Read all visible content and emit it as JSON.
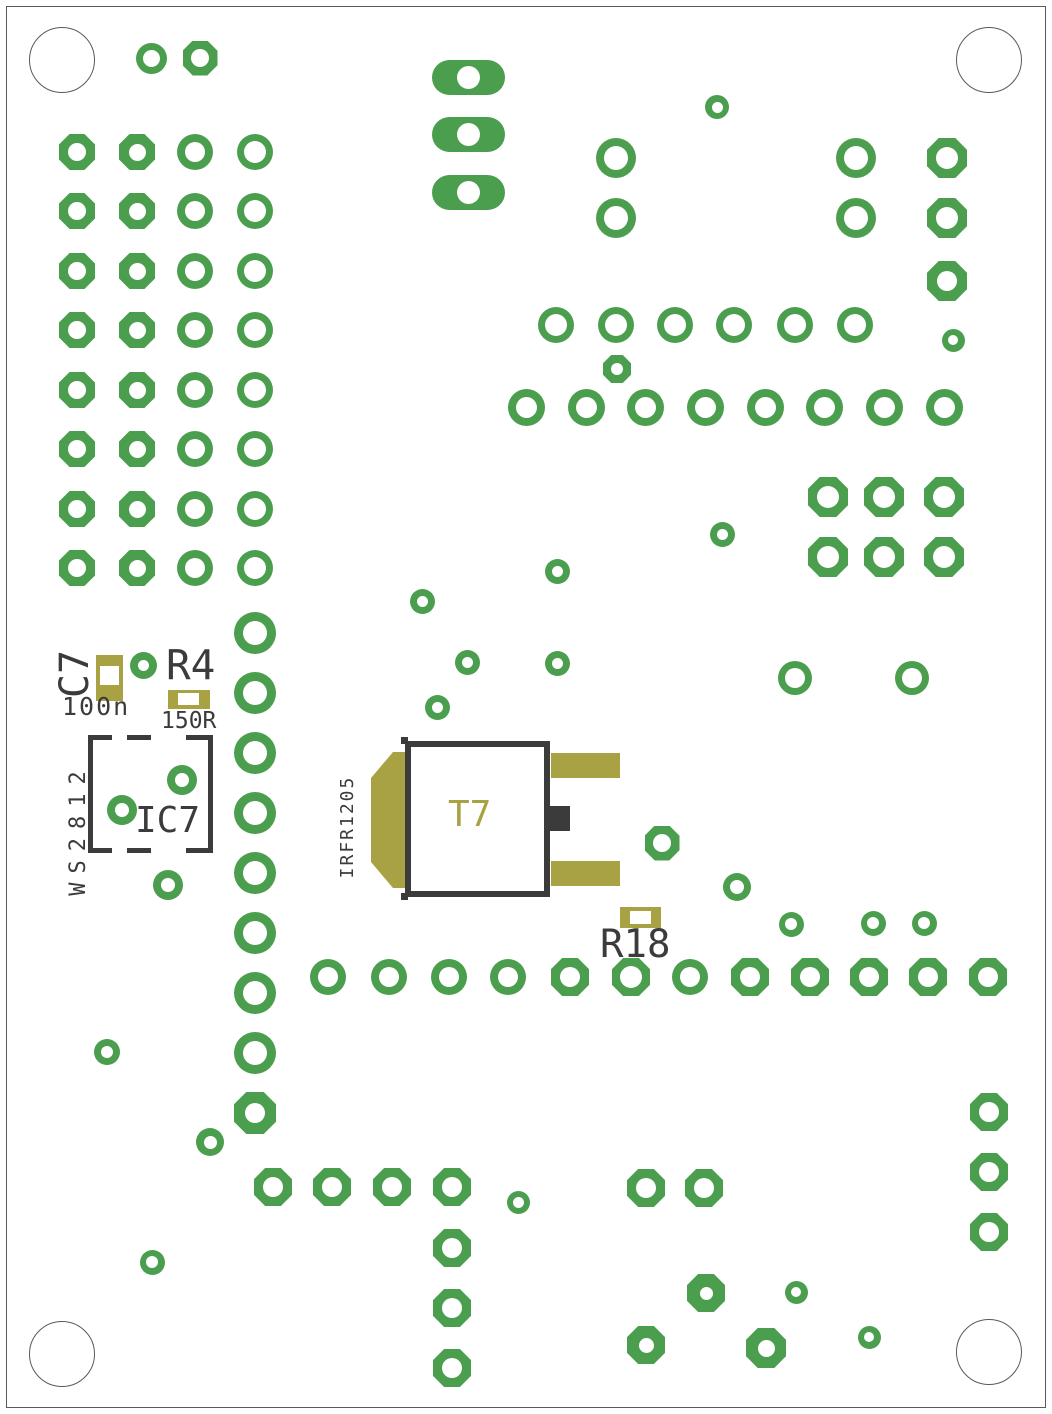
{
  "board": {
    "width": 1052,
    "height": 1414,
    "colors": {
      "copper": "#4a9e4e",
      "silk": "#3b3b3b",
      "smd": "#a9a245",
      "outline": "#5a5a5a",
      "bg": "#ffffff"
    },
    "mounting_holes": [
      {
        "x": 62,
        "y": 60,
        "d": 66
      },
      {
        "x": 989,
        "y": 60,
        "d": 66
      },
      {
        "x": 62,
        "y": 1354,
        "d": 66
      },
      {
        "x": 989,
        "y": 1352,
        "d": 66
      }
    ],
    "pads": [
      [
        151,
        58,
        "c",
        31,
        31,
        17
      ],
      [
        200,
        58,
        "o",
        35,
        35,
        18
      ],
      [
        77,
        152,
        "o",
        36,
        36,
        18
      ],
      [
        137,
        152,
        "o",
        36,
        36,
        17
      ],
      [
        195,
        152,
        "c",
        36,
        36,
        20
      ],
      [
        255,
        152,
        "c",
        36,
        36,
        22
      ],
      [
        77,
        211,
        "o",
        36,
        36,
        18
      ],
      [
        137,
        211,
        "o",
        36,
        36,
        17
      ],
      [
        195,
        211,
        "c",
        36,
        36,
        20
      ],
      [
        255,
        211,
        "c",
        36,
        36,
        22
      ],
      [
        77,
        271,
        "o",
        36,
        36,
        18
      ],
      [
        137,
        271,
        "o",
        36,
        36,
        17
      ],
      [
        195,
        271,
        "c",
        36,
        36,
        20
      ],
      [
        255,
        271,
        "c",
        36,
        36,
        22
      ],
      [
        77,
        330,
        "o",
        36,
        36,
        18
      ],
      [
        137,
        330,
        "o",
        36,
        36,
        17
      ],
      [
        195,
        330,
        "c",
        36,
        36,
        20
      ],
      [
        255,
        330,
        "c",
        36,
        36,
        22
      ],
      [
        77,
        390,
        "o",
        36,
        36,
        18
      ],
      [
        137,
        390,
        "o",
        36,
        36,
        17
      ],
      [
        195,
        390,
        "c",
        36,
        36,
        20
      ],
      [
        255,
        390,
        "c",
        36,
        36,
        22
      ],
      [
        77,
        449,
        "o",
        36,
        36,
        18
      ],
      [
        137,
        449,
        "o",
        36,
        36,
        17
      ],
      [
        195,
        449,
        "c",
        36,
        36,
        20
      ],
      [
        255,
        449,
        "c",
        36,
        36,
        22
      ],
      [
        77,
        509,
        "o",
        36,
        36,
        18
      ],
      [
        137,
        509,
        "o",
        36,
        36,
        17
      ],
      [
        195,
        509,
        "c",
        36,
        36,
        20
      ],
      [
        255,
        509,
        "c",
        36,
        36,
        22
      ],
      [
        77,
        568,
        "o",
        36,
        36,
        18
      ],
      [
        137,
        568,
        "o",
        36,
        36,
        17
      ],
      [
        195,
        568,
        "c",
        36,
        36,
        20
      ],
      [
        255,
        568,
        "c",
        36,
        36,
        22
      ],
      [
        255,
        633,
        "c",
        42,
        42,
        24
      ],
      [
        255,
        693,
        "c",
        42,
        42,
        24
      ],
      [
        255,
        753,
        "c",
        42,
        42,
        24
      ],
      [
        255,
        813,
        "c",
        42,
        42,
        24
      ],
      [
        255,
        873,
        "c",
        42,
        42,
        24
      ],
      [
        255,
        933,
        "c",
        42,
        42,
        24
      ],
      [
        255,
        993,
        "c",
        42,
        42,
        24
      ],
      [
        255,
        1053,
        "c",
        42,
        42,
        24
      ],
      [
        255,
        1113,
        "o",
        42,
        42,
        20
      ],
      [
        468,
        77,
        "s",
        73,
        35,
        23
      ],
      [
        468,
        134,
        "s",
        73,
        35,
        23
      ],
      [
        468,
        192,
        "s",
        73,
        35,
        23
      ],
      [
        717,
        107,
        "c",
        24,
        24,
        11
      ],
      [
        616,
        158,
        "c",
        40,
        40,
        24
      ],
      [
        616,
        218,
        "c",
        40,
        40,
        24
      ],
      [
        856,
        158,
        "c",
        40,
        40,
        24
      ],
      [
        856,
        218,
        "c",
        40,
        40,
        24
      ],
      [
        947,
        158,
        "o",
        40,
        40,
        22
      ],
      [
        947,
        218,
        "o",
        40,
        40,
        22
      ],
      [
        947,
        281,
        "o",
        40,
        40,
        20
      ],
      [
        953,
        340,
        "c",
        23,
        23,
        10
      ],
      [
        556,
        325,
        "c",
        36,
        36,
        22
      ],
      [
        616,
        325,
        "c",
        36,
        36,
        22
      ],
      [
        675,
        325,
        "c",
        36,
        36,
        22
      ],
      [
        734,
        325,
        "c",
        36,
        36,
        22
      ],
      [
        795,
        325,
        "c",
        36,
        36,
        22
      ],
      [
        855,
        325,
        "c",
        36,
        36,
        22
      ],
      [
        617,
        369,
        "o",
        28,
        28,
        12
      ],
      [
        526,
        407,
        "c",
        37,
        37,
        21
      ],
      [
        586,
        407,
        "c",
        37,
        37,
        21
      ],
      [
        645,
        407,
        "c",
        37,
        37,
        21
      ],
      [
        705,
        407,
        "c",
        37,
        37,
        21
      ],
      [
        765,
        407,
        "c",
        37,
        37,
        21
      ],
      [
        824,
        407,
        "c",
        37,
        37,
        21
      ],
      [
        884,
        407,
        "c",
        37,
        37,
        21
      ],
      [
        944,
        407,
        "c",
        37,
        37,
        21
      ],
      [
        828,
        497,
        "o",
        40,
        40,
        22
      ],
      [
        884,
        497,
        "o",
        40,
        40,
        22
      ],
      [
        944,
        497,
        "o",
        40,
        40,
        22
      ],
      [
        828,
        557,
        "o",
        40,
        40,
        22
      ],
      [
        884,
        557,
        "o",
        40,
        40,
        22
      ],
      [
        944,
        557,
        "o",
        40,
        40,
        22
      ],
      [
        422,
        601,
        "c",
        25,
        25,
        11
      ],
      [
        557,
        571,
        "c",
        25,
        25,
        11
      ],
      [
        722,
        534,
        "c",
        25,
        25,
        11
      ],
      [
        467,
        662,
        "c",
        25,
        25,
        11
      ],
      [
        557,
        663,
        "c",
        25,
        25,
        11
      ],
      [
        437,
        707,
        "c",
        25,
        25,
        11
      ],
      [
        143,
        665,
        "c",
        27,
        27,
        11
      ],
      [
        795,
        678,
        "c",
        34,
        34,
        20
      ],
      [
        912,
        678,
        "c",
        34,
        34,
        20
      ],
      [
        122,
        810,
        "c",
        30,
        30,
        14
      ],
      [
        182,
        780,
        "c",
        30,
        30,
        14
      ],
      [
        168,
        885,
        "c",
        30,
        30,
        14
      ],
      [
        662,
        843,
        "o",
        35,
        35,
        18
      ],
      [
        737,
        887,
        "c",
        28,
        28,
        14
      ],
      [
        791,
        924,
        "c",
        25,
        25,
        12
      ],
      [
        873,
        923,
        "c",
        25,
        25,
        12
      ],
      [
        924,
        923,
        "c",
        25,
        25,
        12
      ],
      [
        328,
        977,
        "c",
        36,
        36,
        20
      ],
      [
        389,
        977,
        "c",
        36,
        36,
        20
      ],
      [
        449,
        977,
        "c",
        36,
        36,
        20
      ],
      [
        508,
        977,
        "c",
        36,
        36,
        20
      ],
      [
        570,
        977,
        "o",
        38,
        38,
        20
      ],
      [
        631,
        977,
        "o",
        38,
        38,
        22
      ],
      [
        690,
        977,
        "c",
        36,
        36,
        20
      ],
      [
        750,
        977,
        "o",
        38,
        38,
        20
      ],
      [
        810,
        977,
        "o",
        38,
        38,
        20
      ],
      [
        869,
        977,
        "o",
        38,
        38,
        20
      ],
      [
        928,
        977,
        "o",
        38,
        38,
        20
      ],
      [
        988,
        977,
        "o",
        38,
        38,
        20
      ],
      [
        107,
        1052,
        "c",
        26,
        26,
        12
      ],
      [
        210,
        1142,
        "c",
        28,
        28,
        13
      ],
      [
        273,
        1187,
        "o",
        38,
        38,
        20
      ],
      [
        332,
        1187,
        "o",
        38,
        38,
        20
      ],
      [
        392,
        1187,
        "o",
        38,
        38,
        20
      ],
      [
        452,
        1187,
        "o",
        38,
        38,
        20
      ],
      [
        518,
        1202,
        "c",
        23,
        23,
        11
      ],
      [
        152,
        1262,
        "c",
        25,
        25,
        12
      ],
      [
        452,
        1248,
        "o",
        38,
        38,
        20
      ],
      [
        452,
        1308,
        "o",
        38,
        38,
        20
      ],
      [
        452,
        1368,
        "o",
        38,
        38,
        20
      ],
      [
        646,
        1188,
        "o",
        38,
        38,
        20
      ],
      [
        704,
        1188,
        "o",
        38,
        38,
        20
      ],
      [
        989,
        1112,
        "o",
        38,
        38,
        20
      ],
      [
        989,
        1172,
        "o",
        38,
        38,
        20
      ],
      [
        989,
        1232,
        "o",
        38,
        38,
        20
      ],
      [
        706,
        1293,
        "o",
        38,
        38,
        13
      ],
      [
        796,
        1292,
        "c",
        23,
        23,
        10
      ],
      [
        869,
        1337,
        "c",
        23,
        23,
        10
      ],
      [
        646,
        1345,
        "o",
        38,
        38,
        15
      ],
      [
        766,
        1348,
        "o",
        40,
        40,
        17
      ]
    ],
    "smd_pads": [
      {
        "name": "c7-pad",
        "x": 96,
        "y": 655,
        "w": 27,
        "h": 46,
        "hw": 19,
        "hh": 19,
        "hx": 4,
        "hy": 11
      },
      {
        "name": "r4-pad",
        "x": 168,
        "y": 690,
        "w": 42,
        "h": 19,
        "hw": 21,
        "hh": 12,
        "hx": 10,
        "hy": 3
      },
      {
        "name": "r18-pad",
        "x": 620,
        "y": 907,
        "w": 41,
        "h": 21,
        "hw": 21,
        "hh": 13,
        "hx": 10,
        "hy": 4
      }
    ],
    "components": {
      "c7": {
        "ref": "C7",
        "value": "100n"
      },
      "r4": {
        "ref": "R4",
        "value": "150R"
      },
      "ic7": {
        "ref": "IC7",
        "value": "WS2812"
      },
      "t7": {
        "ref": "T7",
        "value": "IRFR1205"
      },
      "r18": {
        "ref": "R18"
      }
    }
  }
}
